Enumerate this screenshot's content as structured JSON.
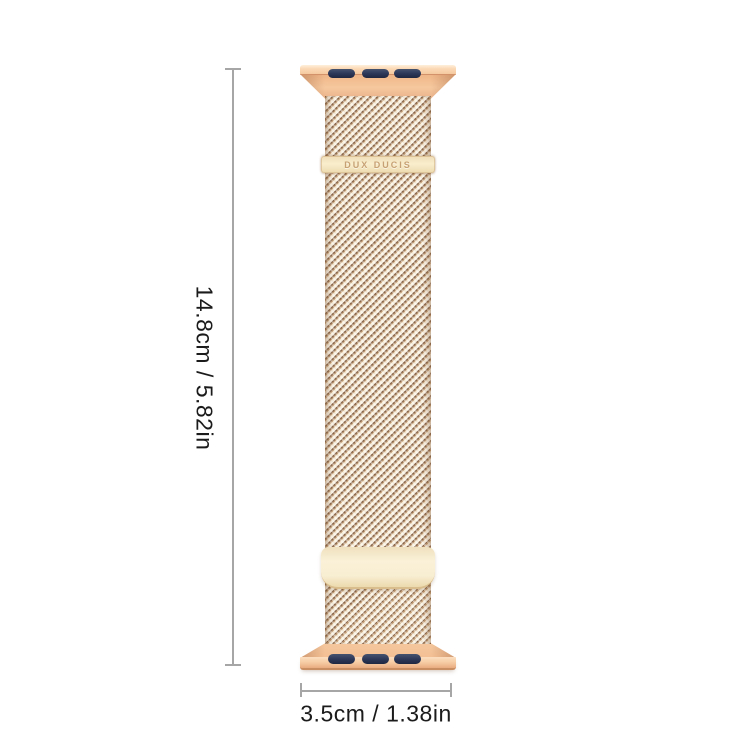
{
  "meta": {
    "kind": "product-dimension-diagram",
    "subject": "Milanese loop magnetic watch band, rose gold"
  },
  "brand_plate": {
    "label": "DUX DUCIS"
  },
  "dimensions": {
    "height": {
      "label": "14.8cm / 5.82in"
    },
    "width": {
      "label": "3.5cm / 1.38in"
    }
  },
  "theme": {
    "background": "#ffffff",
    "band-gold": "#f5c9a0",
    "band-gold-dark": "#e9b188",
    "band-edge": "#d3926a",
    "mesh-base": "#f1e0c2",
    "mesh-dark": "#8a674b",
    "slot-navy": "#2b3657",
    "plate-cream": "#f8eed2",
    "plate-edge": "#d9bd8c",
    "brand-text": "#c7a173",
    "dim-line": "#a6a6a6",
    "dim-text": "#1b1b1b"
  }
}
